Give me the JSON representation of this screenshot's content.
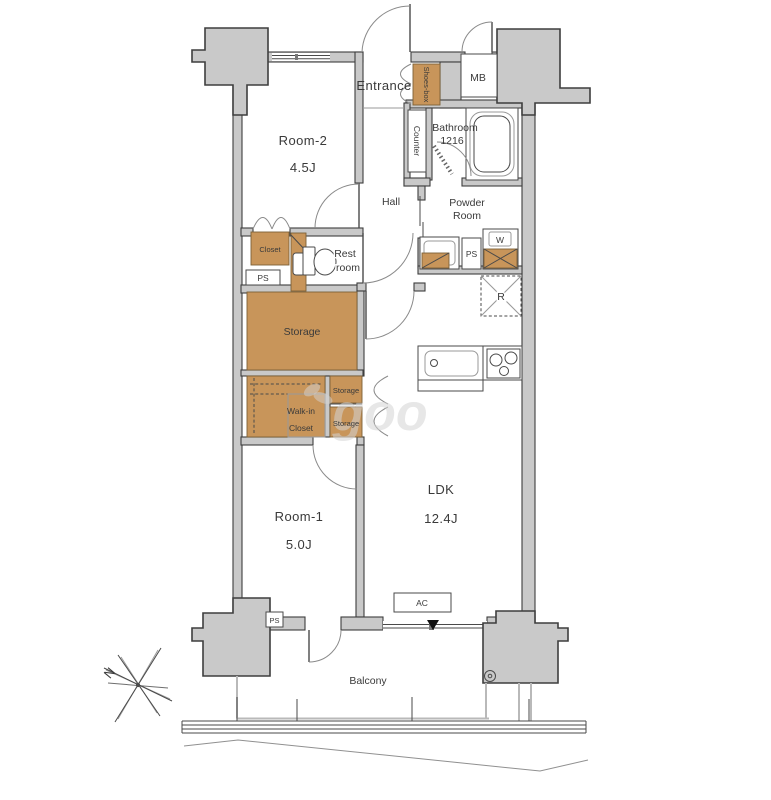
{
  "rooms": {
    "room2": {
      "name": "Room-2",
      "size": "4.5J"
    },
    "room1": {
      "name": "Room-1",
      "size": "5.0J"
    },
    "ldk": {
      "name": "LDK",
      "size": "12.4J"
    },
    "entrance": "Entrance",
    "hall": "Hall",
    "mb": "MB",
    "bathroom": {
      "line1": "Bathroom",
      "line2": "1216"
    },
    "powder_room": {
      "line1": "Powder",
      "line2": "Room"
    },
    "rest_room": {
      "line1": "Rest",
      "line2": "room"
    },
    "balcony": "Balcony"
  },
  "storage": {
    "shoes_box": "Shoes-box",
    "counter": "Counter",
    "closet": "Closet",
    "storage_main": "Storage",
    "walk_in_closet": {
      "line1": "Walk-in",
      "line2": "Closet"
    },
    "storage_top": "Storage",
    "storage_bottom": "Storage"
  },
  "fixtures": {
    "washer": "W",
    "refrigerator": "R",
    "ac": "AC"
  },
  "shafts": {
    "ps_closet": "PS",
    "ps_powder": "PS",
    "ps_balcony": "PS"
  },
  "compass": {
    "north": "N"
  },
  "watermark": "goo",
  "colors": {
    "wall_fill": "#c9c9c9",
    "wood_fill": "#c8955a",
    "outline": "#3e3e3e",
    "watermark": "#d4d4d4"
  }
}
